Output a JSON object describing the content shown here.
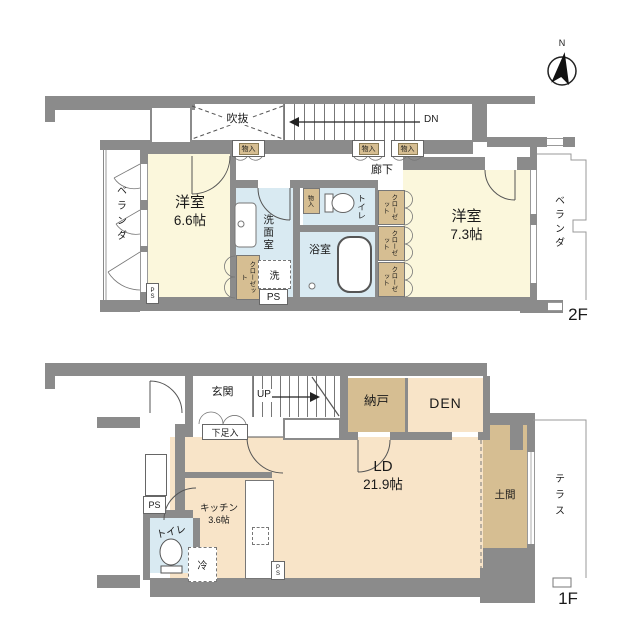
{
  "compass": {
    "north": "N"
  },
  "floor2": {
    "floor_label": "2F",
    "void": "吹抜",
    "stairs_down": "DN",
    "corridor": "廊下",
    "storage": "物入",
    "bedroom_left": {
      "name": "洋室",
      "size": "6.6帖"
    },
    "bedroom_right": {
      "name": "洋室",
      "size": "7.3帖"
    },
    "washroom": "洗面室",
    "washer": "洗",
    "bathroom": "浴室",
    "toilet": "トイレ",
    "closet": "クローゼット",
    "veranda": "ベランダ",
    "ps": "PS"
  },
  "floor1": {
    "floor_label": "1F",
    "entrance": "玄関",
    "stairs_up": "UP",
    "shoe_storage": "下足入",
    "storage_room": "納戸",
    "den": "DEN",
    "living_dining": {
      "name": "LD",
      "size": "21.9帖"
    },
    "kitchen": {
      "name": "キッチン",
      "size": "3.6帖"
    },
    "toilet": "トイレ",
    "fridge": "冷",
    "doma": "土間",
    "terrace": "テラス",
    "ps": "PS"
  },
  "colors": {
    "wall": "#8b8b8b",
    "room_yellow": "#FBF7DC",
    "room_blue": "#D9EAF2",
    "room_tan": "#D6BE92",
    "room_peach": "#F8E4C8"
  }
}
